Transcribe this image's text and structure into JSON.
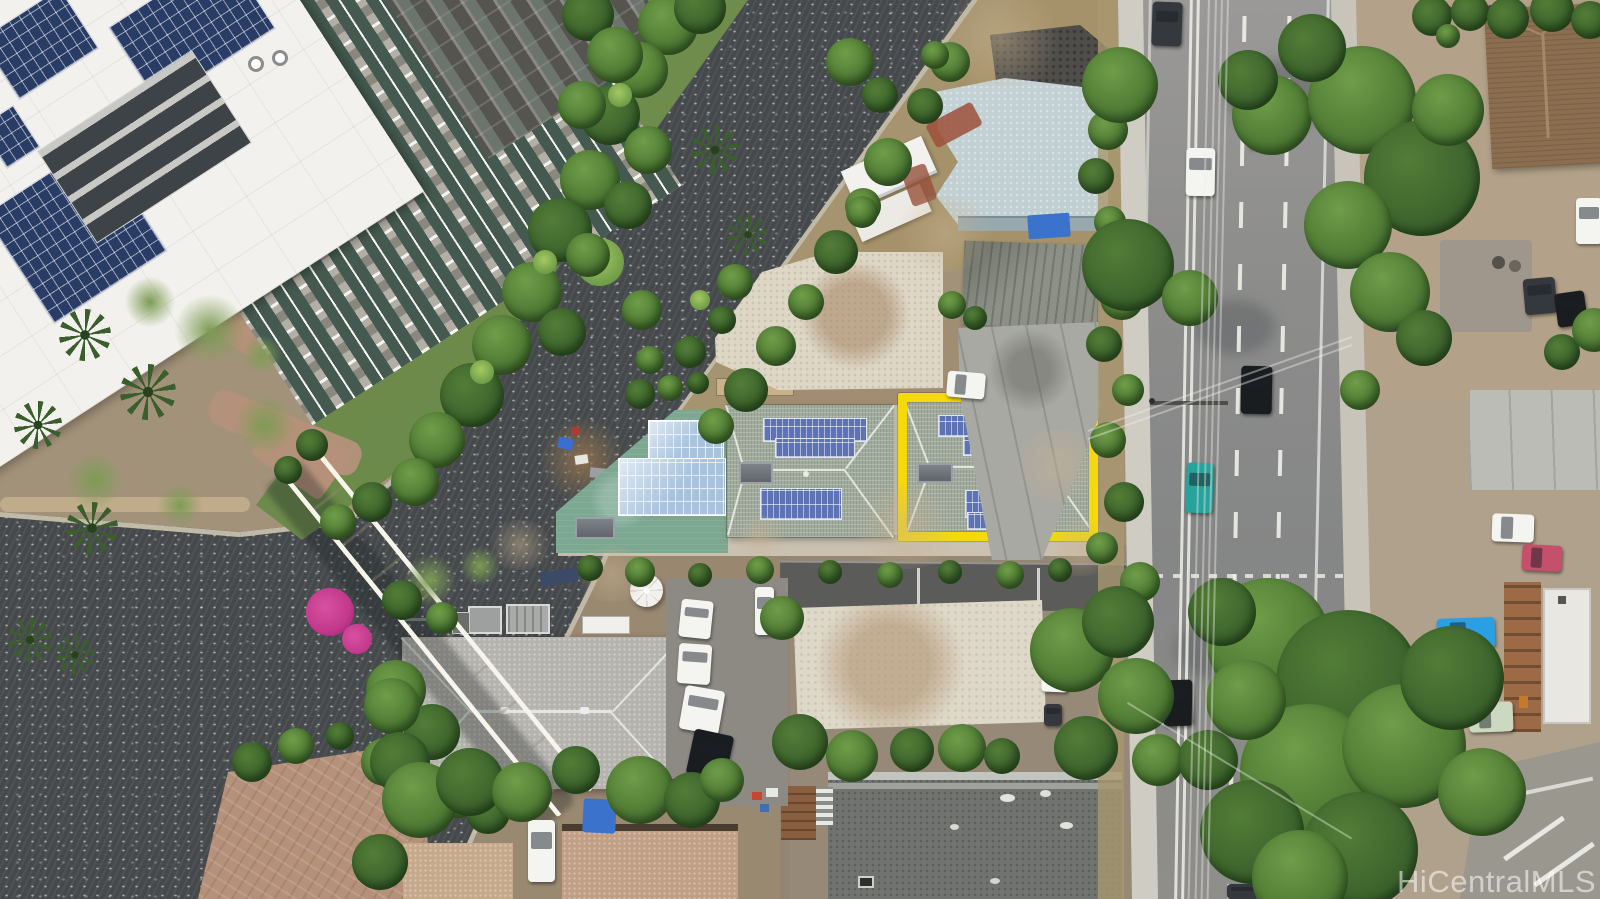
{
  "watermark": {
    "text": "HiCentralMLS"
  },
  "colors": {
    "water": "#45494c",
    "bank": "#cbc3b0",
    "vegDark": "#3a5f2c",
    "vegMid": "#527d36",
    "vegLight": "#6f9d48",
    "grass": "#7d9c55",
    "dirt": "#a3927a",
    "dirtDark": "#8a7a5e",
    "sand": "#c7b190",
    "brick": "#b5917a",
    "road": "#8e8e8d",
    "roadLight": "#9e9d9a",
    "sidewalk": "#cfccc3",
    "marking": "#f0efe9",
    "asphaltLane": "#5b5b59",
    "whiteRoof": "#f2f1ed",
    "facade": "#b4afa5",
    "facadeDark": "#56544e",
    "windowGlass": "#44594f",
    "solarDark": "#283c66",
    "solarBlue": "#5d73b4",
    "solarPale": "#a9c3de",
    "heater": "#565b5f",
    "tealDeck": "#7ca892",
    "shingle": "#a2ac9e",
    "ridge": "#cfd6c9",
    "highlight": "#f6d90a",
    "paleBlueRoof": "#bccdd1",
    "creamRoof": "#ded7c6",
    "rust": "#a3815f",
    "grayRoofOld": "#8d9086",
    "concrete": "#a9a9a3",
    "grayFlat": "#70736f",
    "parapet": "#c2c5bf",
    "tanRoof": "#c6a88b",
    "tanRoof2": "#c09f84",
    "brownRoof": "#8b6d4f",
    "brownShed": "#8a5f3f",
    "darkEave": "#4a3c2e",
    "bridgeDeck": "#e8ddc2",
    "bridgeRail": "#f7f4ec",
    "umbrella": "#f2f1ed",
    "tarp": "#3a72cc",
    "flower": "#c2388c",
    "carWhite": "#f4f4f1",
    "carBlack": "#1a1d20",
    "carDark": "#35383c",
    "carGray": "#6f767c",
    "carBlue": "#2b9fe3",
    "carRed": "#c4506b",
    "carTeal": "#27a39b",
    "carGreen": "#ccd9c0",
    "wmColor": "rgba(255,255,255,0.55)"
  }
}
